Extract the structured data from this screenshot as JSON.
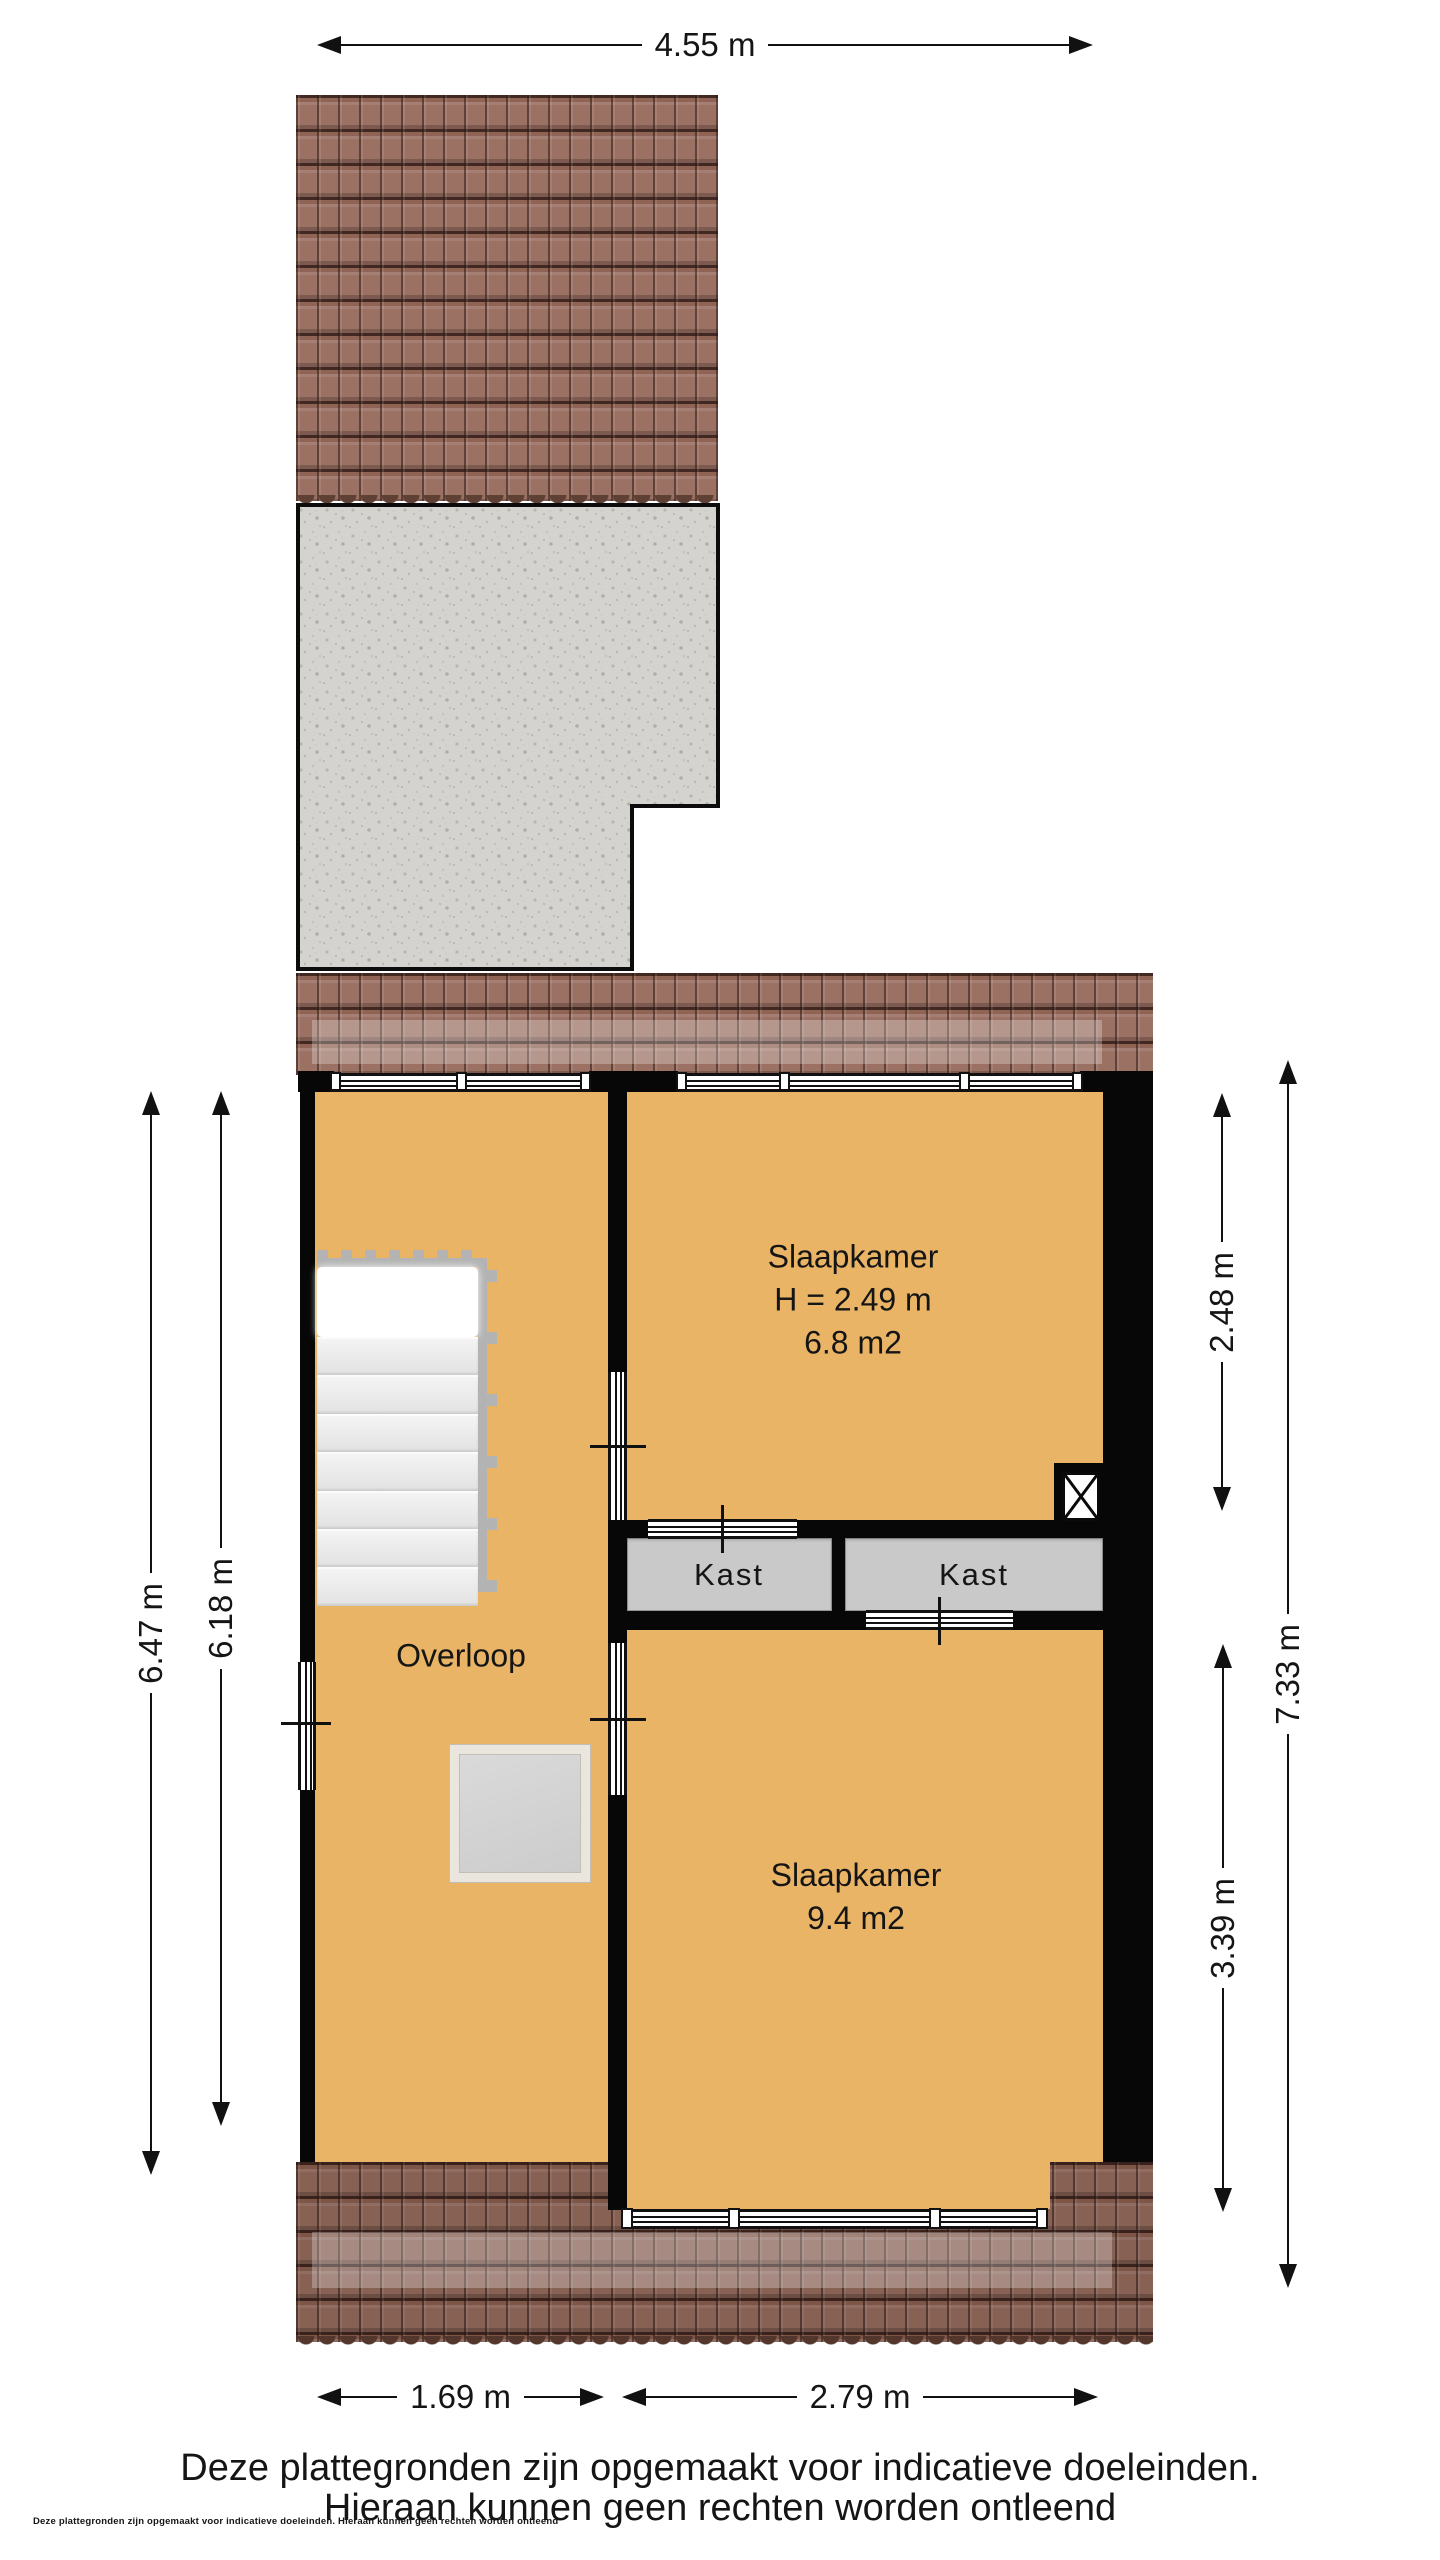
{
  "dimensions": {
    "top_width": "4.55 m",
    "left_outer": "6.47 m",
    "left_inner": "6.18 m",
    "right_top": "2.48 m",
    "right_full": "7.33 m",
    "right_bottom": "3.39 m",
    "bottom_left": "1.69 m",
    "bottom_right": "2.79 m"
  },
  "rooms": {
    "overloop": {
      "label": "Overloop"
    },
    "slaapkamer_top": {
      "name": "Slaapkamer",
      "height": "H = 2.49 m",
      "area": "6.8 m2"
    },
    "slaapkamer_bottom": {
      "name": "Slaapkamer",
      "area": "9.4 m2"
    },
    "kast_left": {
      "label": "Kast"
    },
    "kast_right": {
      "label": "Kast"
    }
  },
  "footer": {
    "line1": "Deze plattegronden zijn opgemaakt voor indicatieve doeleinden.",
    "line2": "Hieraan kunnen geen rechten worden ontleend",
    "fineprint": "Deze plattegronden zijn opgemaakt voor indicatieve doeleinden. Hieraan kunnen geen rechten worden ontleend"
  },
  "colors": {
    "floor_orange": "#e9b466",
    "roof_tile": "#9b7163",
    "wall_black": "#070707",
    "concrete_gray": "#d4d3d0",
    "closet_gray": "#c9c9c9",
    "accent_text": "#151515"
  }
}
